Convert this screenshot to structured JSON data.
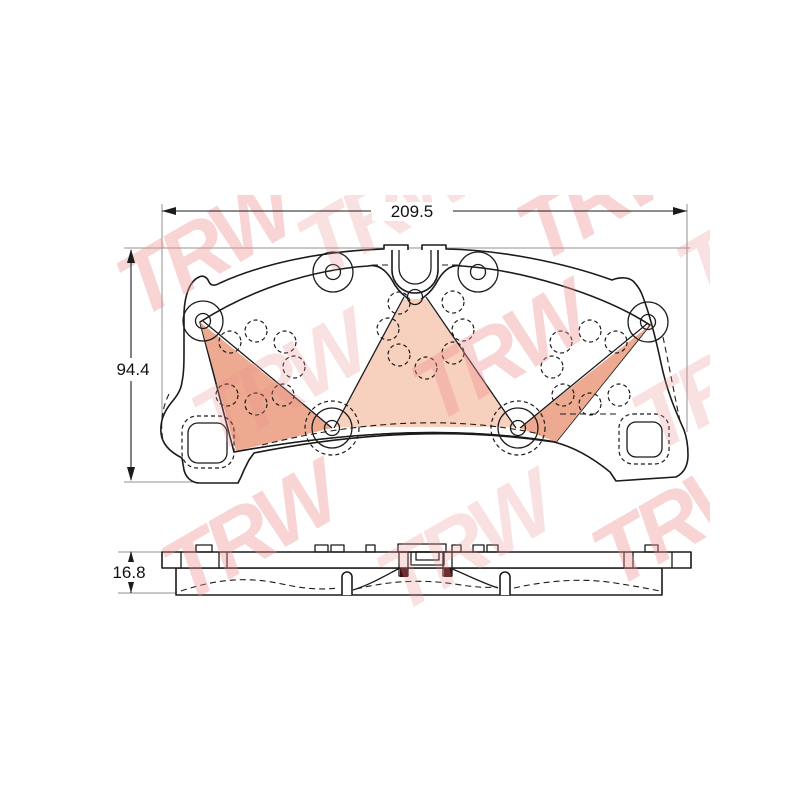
{
  "dimensions": {
    "width_mm": "209.5",
    "height_mm": "94.4",
    "thickness_mm": "16.8"
  },
  "brand": {
    "watermark": "TRW",
    "color": "#ef8f8f"
  },
  "colors": {
    "friction": "#f4c0aa",
    "friction_dark": "#edaa90",
    "friction_light": "#f8d0be",
    "backplate": "#ffffff",
    "clip_mark": "#3f0e0e"
  }
}
